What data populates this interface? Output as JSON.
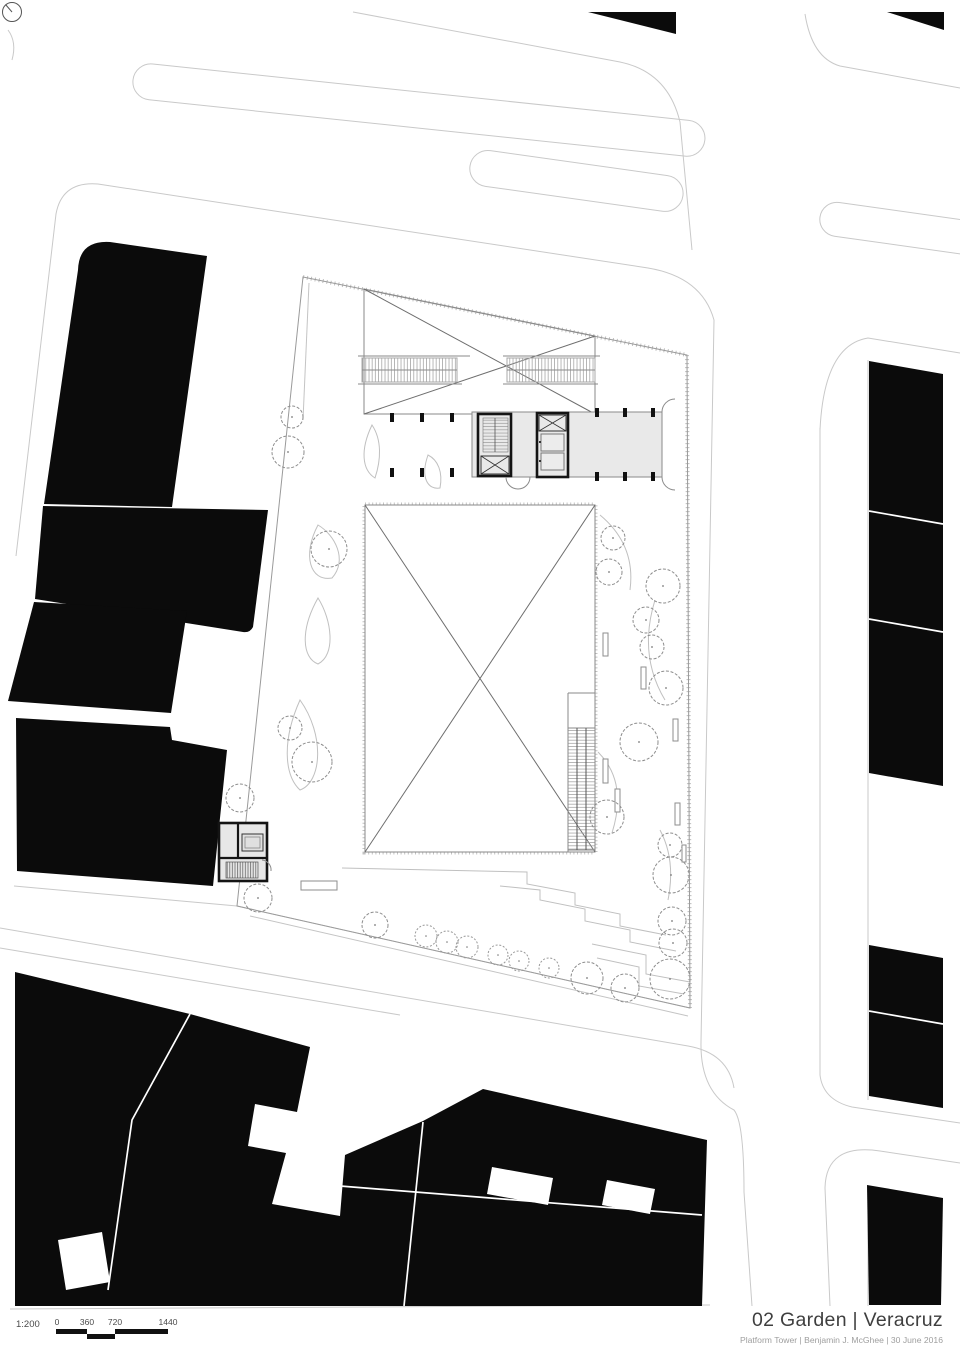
{
  "title_block": {
    "title": "02 Garden | Veracruz",
    "credit": "Platform Tower | Benjamin J. McGhee | 30 June 2016"
  },
  "scale_bar": {
    "ratio": "1:200",
    "ticks": [
      "0",
      "360",
      "720",
      "1440"
    ]
  },
  "icons": {
    "north_arrow": "north-arrow"
  },
  "colors": {
    "building_fill": "#0b0b0b",
    "street_line": "#c9c9c9",
    "site_line": "#9a9a9a",
    "slab_fill": "#e9e9e9",
    "title_text": "#3f3f3f",
    "credit_text": "#9e9e9e"
  }
}
